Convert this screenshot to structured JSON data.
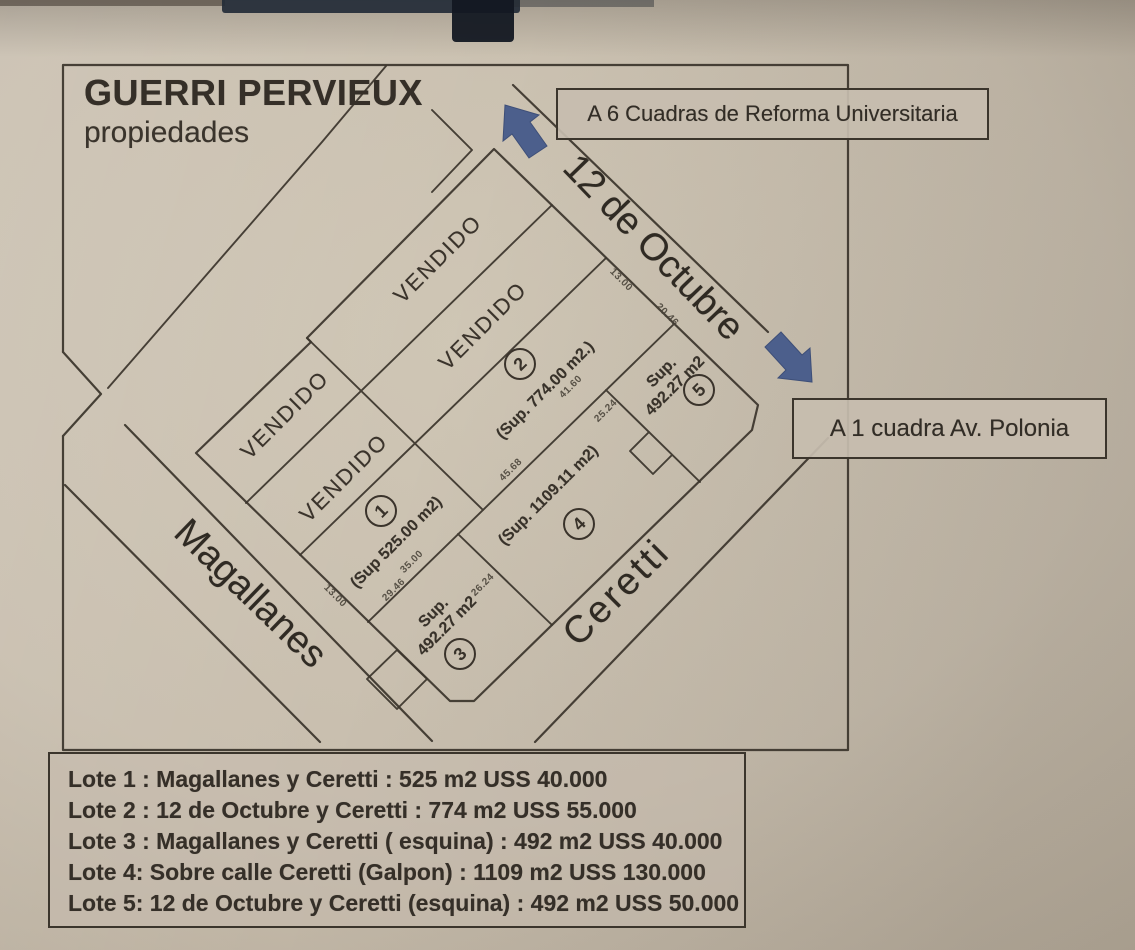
{
  "photo": {
    "paper_color": "#c8beae",
    "ink_color": "#3b352c",
    "arrow_color": "#4c5f8c"
  },
  "header": {
    "brand_line1": "GUERRI PERVIEUX",
    "brand_line2": "propiedades"
  },
  "direction_boxes": {
    "box1": "A 6 Cuadras de Reforma Universitaria",
    "box2": "A 1 cuadra Av. Polonia"
  },
  "streets": {
    "street1": "12 de Octubre",
    "street2": "Magallanes",
    "street3": "Ceretti"
  },
  "map": {
    "sold_label": "VENDIDO",
    "lot1": {
      "circle": "1",
      "label": "(Sup 525.00 m2)"
    },
    "lot2": {
      "circle": "2",
      "label": "(Sup. 774.00 m2.)"
    },
    "lot3": {
      "circle": "3",
      "label_line1": "Sup.",
      "label_line2": "492.27 m2"
    },
    "lot4": {
      "circle": "4",
      "label": "(Sup. 1109.11 m2)"
    },
    "lot5": {
      "circle": "5",
      "label_line1": "Sup.",
      "label_line2": "492.27 m2"
    },
    "dimensions": {
      "d1": "13.00",
      "d2": "20.46",
      "d3": "25.24",
      "d4": "45.68",
      "d5": "41.60",
      "d6": "35.00",
      "d7": "29.46",
      "d8": "13.00",
      "d9": "26.24"
    }
  },
  "price_list": {
    "line1": "Lote 1 : Magallanes y Ceretti : 525 m2  USS 40.000",
    "line2": "Lote 2 : 12 de Octubre y Ceretti : 774 m2  USS 55.000",
    "line3": "Lote 3 : Magallanes y Ceretti ( esquina) : 492 m2 USS 40.000",
    "line4": "Lote 4: Sobre calle Ceretti (Galpon) : 1109 m2 USS 130.000",
    "line5": "Lote 5: 12 de Octubre y Ceretti (esquina) : 492 m2  USS 50.000"
  }
}
